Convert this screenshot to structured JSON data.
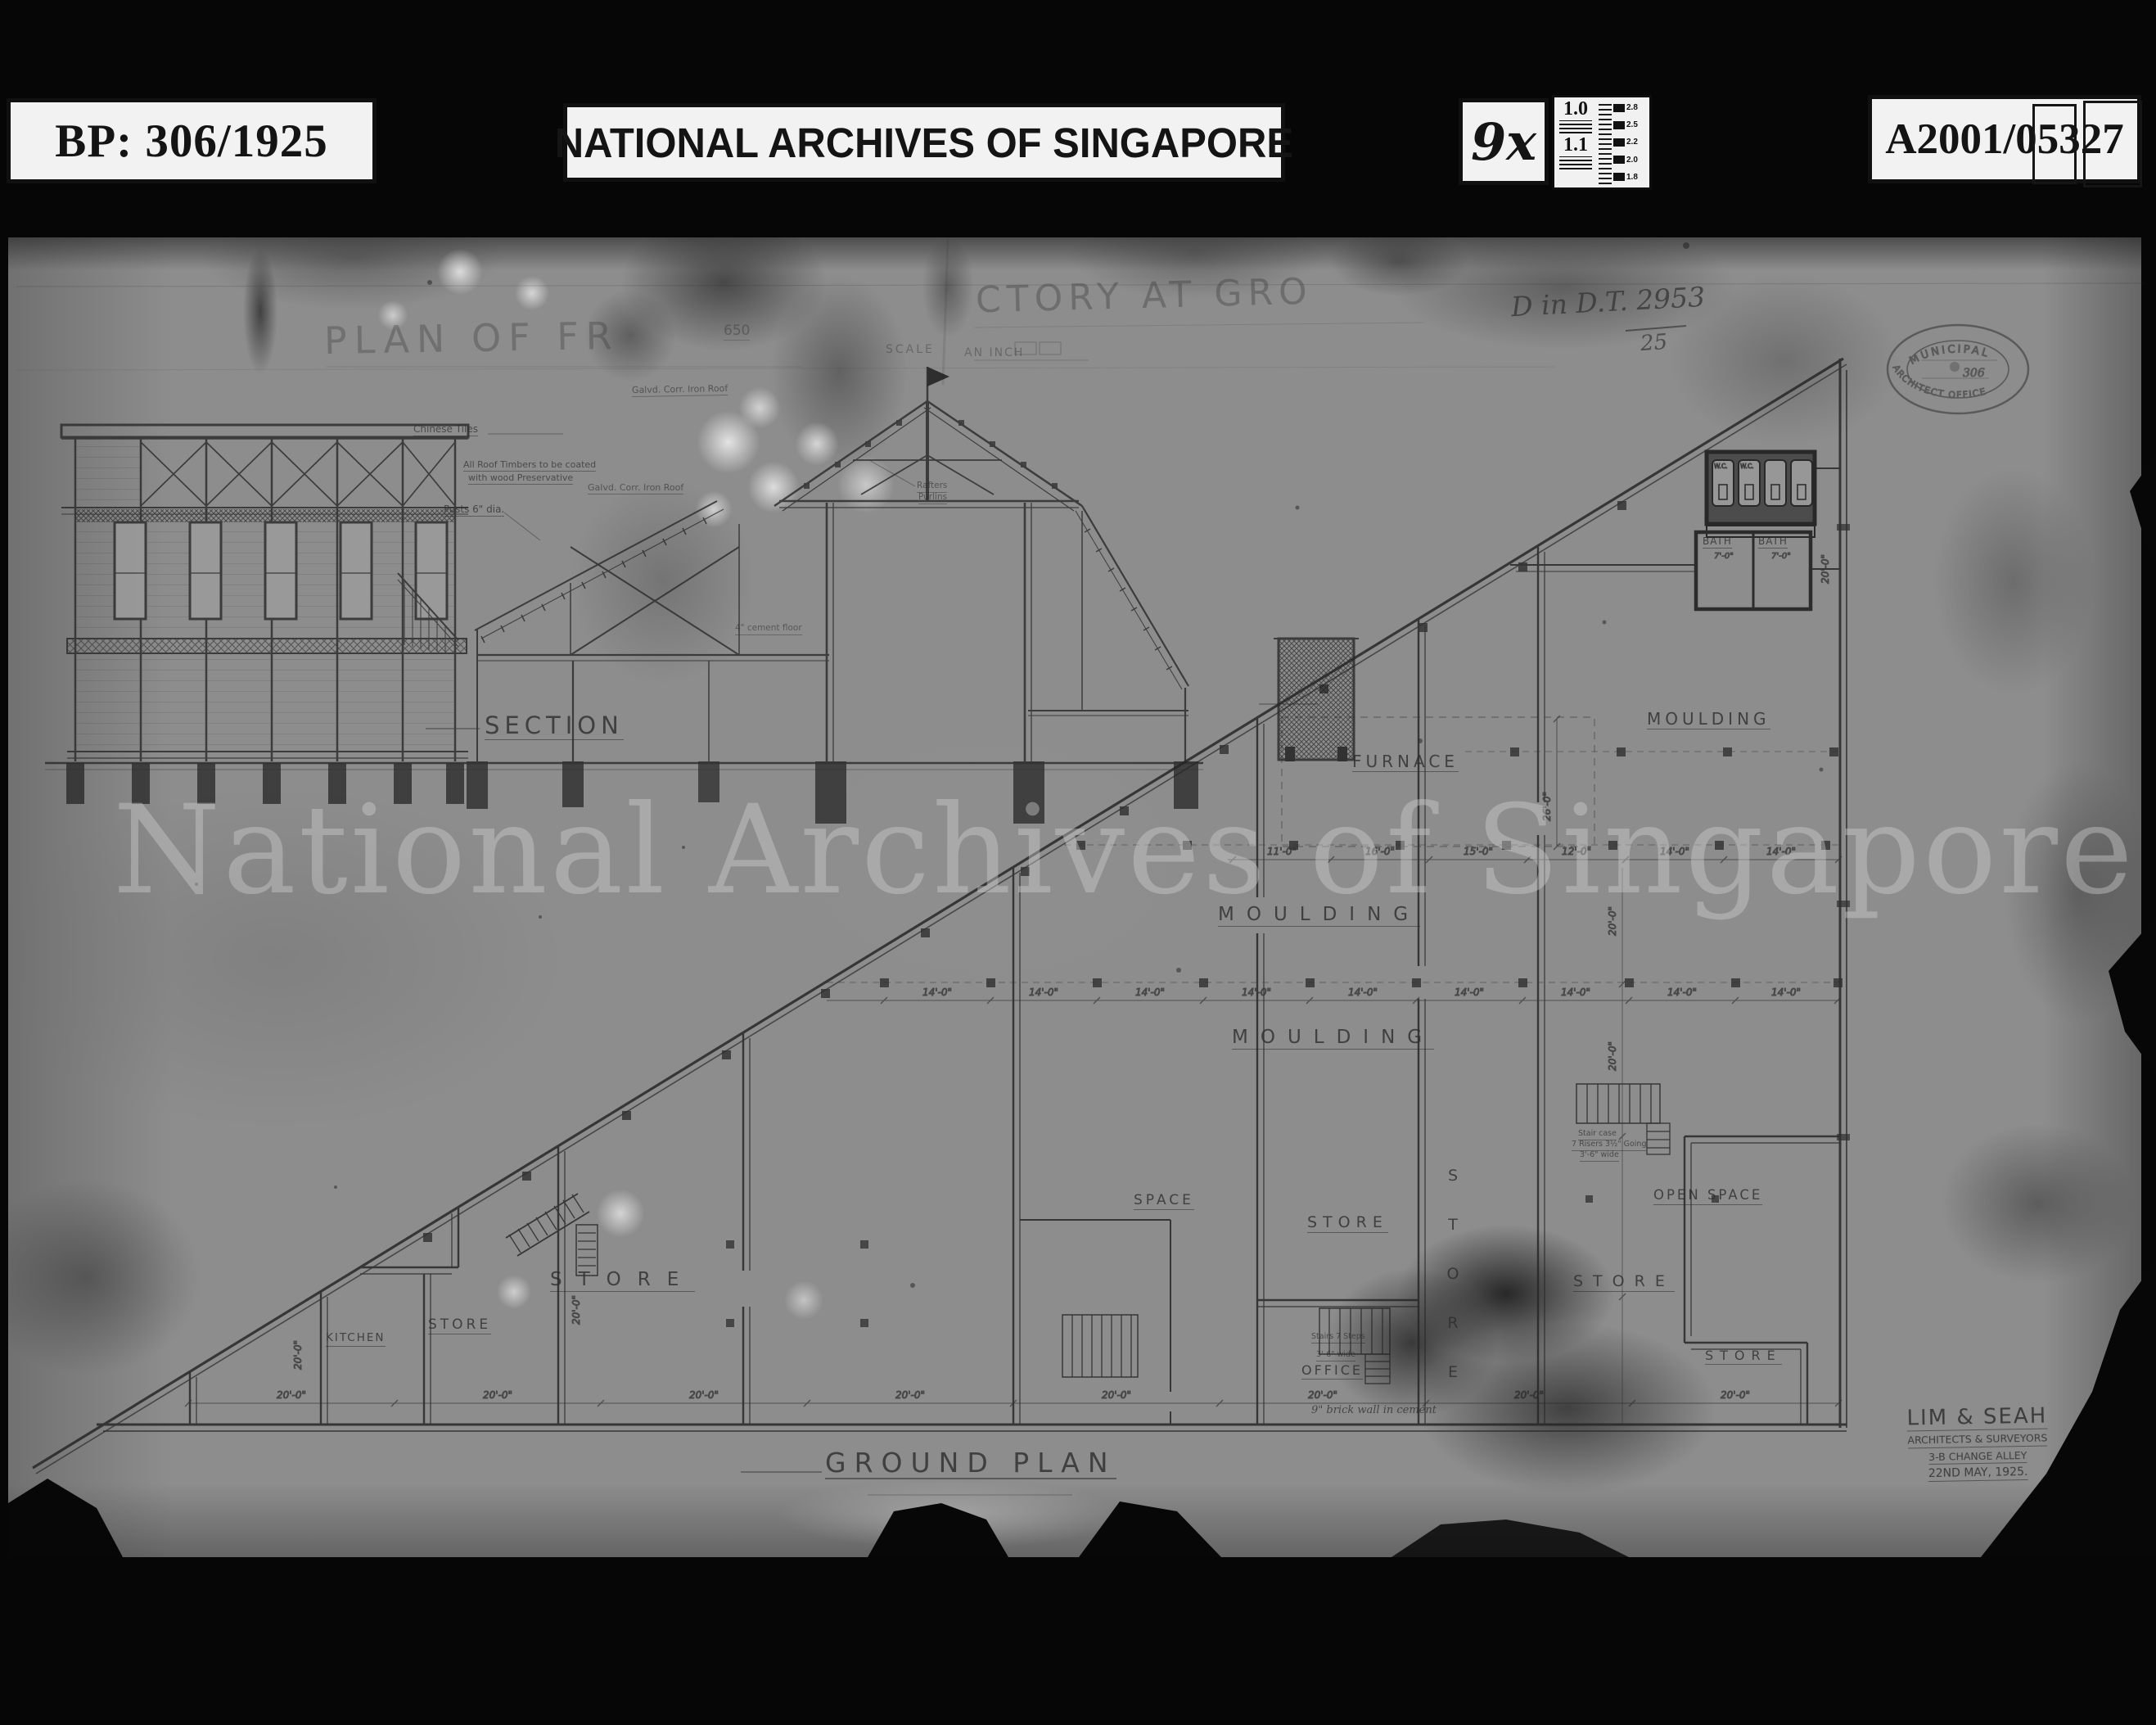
{
  "header": {
    "bp_label": "BP: 306/1925",
    "archives_label": "NATIONAL ARCHIVES OF SINGAPORE",
    "magnification": "9x",
    "reference": "A2001/05327",
    "calibration": {
      "v1": "1.0",
      "v2": "1.1",
      "r1": "2.8",
      "r2": "2.5",
      "r3": "2.2",
      "r4": "2.0",
      "r5": "1.8"
    }
  },
  "watermark": "National Archives of Singapore",
  "title": {
    "fragment_left": "PLAN OF FR",
    "fragment_right": "CTORY AT GRO",
    "scale_number": "650",
    "scale_left": "SCALE",
    "scale_right": "AN INCH"
  },
  "notes": {
    "handwritten_ref": "D in D.T. 2953",
    "handwritten_den": "25",
    "stamp_top": "MUNICIPAL",
    "stamp_bottom": "ARCHITECT OFFICE",
    "stamp_center": "306"
  },
  "section": {
    "label": "SECTION",
    "ann_tiles": "Chinese Tiles",
    "ann_timbers_1": "All Roof Timbers to be coated",
    "ann_timbers_2": "with wood Preservative",
    "ann_posts": "Posts 6\" dia.",
    "ann_roof": "Galvd. Corr. Iron Roof",
    "ann_rafters": "Rafters",
    "ann_purlins": "Purlins",
    "ann_cement": "4\" cement floor"
  },
  "plan": {
    "label": "GROUND PLAN",
    "rooms": {
      "furnace": "FURNACE",
      "moulding": "MOULDING",
      "space": "SPACE",
      "store": "STORE",
      "open_space": "OPEN SPACE",
      "office": "OFFICE",
      "kitchen": "KITCHEN",
      "bath": "BATH",
      "wc": "W.C."
    },
    "stair_note_1": "Stair case",
    "stair_note_2": "7 Risers 3½\" Going",
    "stair_note_3": "3'-6\" wide",
    "stair_note_b1": "Stairs 7 Steps",
    "stair_note_b2": "3'-6\" wide",
    "wall_note": "9\" brick wall in cement",
    "dims": {
      "d20": "20'-0\"",
      "d14": "14'-0\"",
      "d16": "16'-0\"",
      "d15": "15'-0\"",
      "d12": "12'-0\"",
      "d11": "11'-0\"",
      "d26": "26'-0\"",
      "d7": "7'-0\""
    }
  },
  "architect": {
    "name": "LIM & SEAH",
    "role": "ARCHITECTS & SURVEYORS",
    "address": "3-B CHANGE ALLEY",
    "date": "22ND MAY, 1925."
  }
}
